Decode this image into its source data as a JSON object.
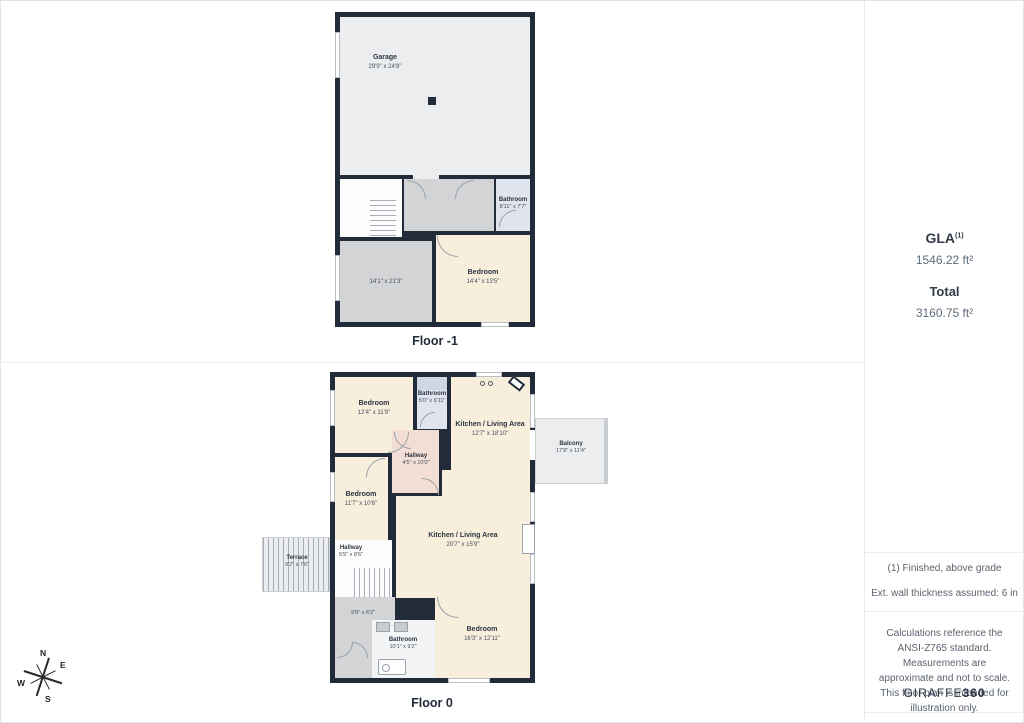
{
  "sidebar": {
    "gla": {
      "label": "GLA",
      "sup": "(1)",
      "value": "1546.22 ft²"
    },
    "total": {
      "label": "Total",
      "value": "3160.75 ft²"
    },
    "notes": {
      "finished": "(1) Finished, above grade",
      "wall": "Ext. wall thickness assumed: 6 in"
    },
    "disclaimer": "Calculations reference the ANSI-Z765 standard. Measurements are approximate and not to scale. This floor plan is intended for illustration only.",
    "brand": {
      "name": "GIRAFFE",
      "suffix": "360"
    }
  },
  "floor_minus1": {
    "label": "Floor -1",
    "rooms": {
      "garage": {
        "name": "Garage",
        "dims": "29'9\" x 24'8\""
      },
      "bathroom": {
        "name": "Bathroom",
        "dims": "8'11\" x 7'7\""
      },
      "rec_room": {
        "dims": "14'1\" x 21'3\""
      },
      "bedroom": {
        "name": "Bedroom",
        "dims": "14'4\" x 13'5\""
      }
    }
  },
  "floor_0": {
    "label": "Floor 0",
    "rooms": {
      "bedroom_top": {
        "name": "Bedroom",
        "dims": "12'4\" x 11'9\""
      },
      "bathroom_top": {
        "name": "Bathroom",
        "dims": "5'0\" x 6'11\""
      },
      "kitchen_upper": {
        "name": "Kitchen / Living Area",
        "dims": "12'7\" x 18'10\""
      },
      "balcony": {
        "name": "Balcony",
        "dims": "17'8\" x 11'4\""
      },
      "hallway_upper": {
        "name": "Hallway",
        "dims": "4'5\" x 10'0\""
      },
      "bedroom_mid": {
        "name": "Bedroom",
        "dims": "11'7\" x 10'6\""
      },
      "kitchen_main": {
        "name": "Kitchen / Living Area",
        "dims": "20'7\" x 15'9\""
      },
      "hallway_lower": {
        "name": "Hallway",
        "dims": "5'5\" x 8'6\""
      },
      "terrace": {
        "name": "Terrace",
        "dims": "9'2\" x 7'6\""
      },
      "storage": {
        "dims": "9'8\" x 6'2\""
      },
      "bathroom_lower": {
        "name": "Bathroom",
        "dims": "10'1\" x 9'2\""
      },
      "bedroom_lower": {
        "name": "Bedroom",
        "dims": "16'3\" x 12'11\""
      }
    }
  },
  "compass": {
    "n": "N",
    "e": "E",
    "s": "S",
    "w": "W"
  },
  "colors": {
    "wall": "#222b39",
    "room_beige": "#f8eedc",
    "room_gray": "#d3d4d6",
    "room_light": "#ecedef",
    "room_blue": "#dfe4ee",
    "room_pink": "#f3ded6"
  }
}
